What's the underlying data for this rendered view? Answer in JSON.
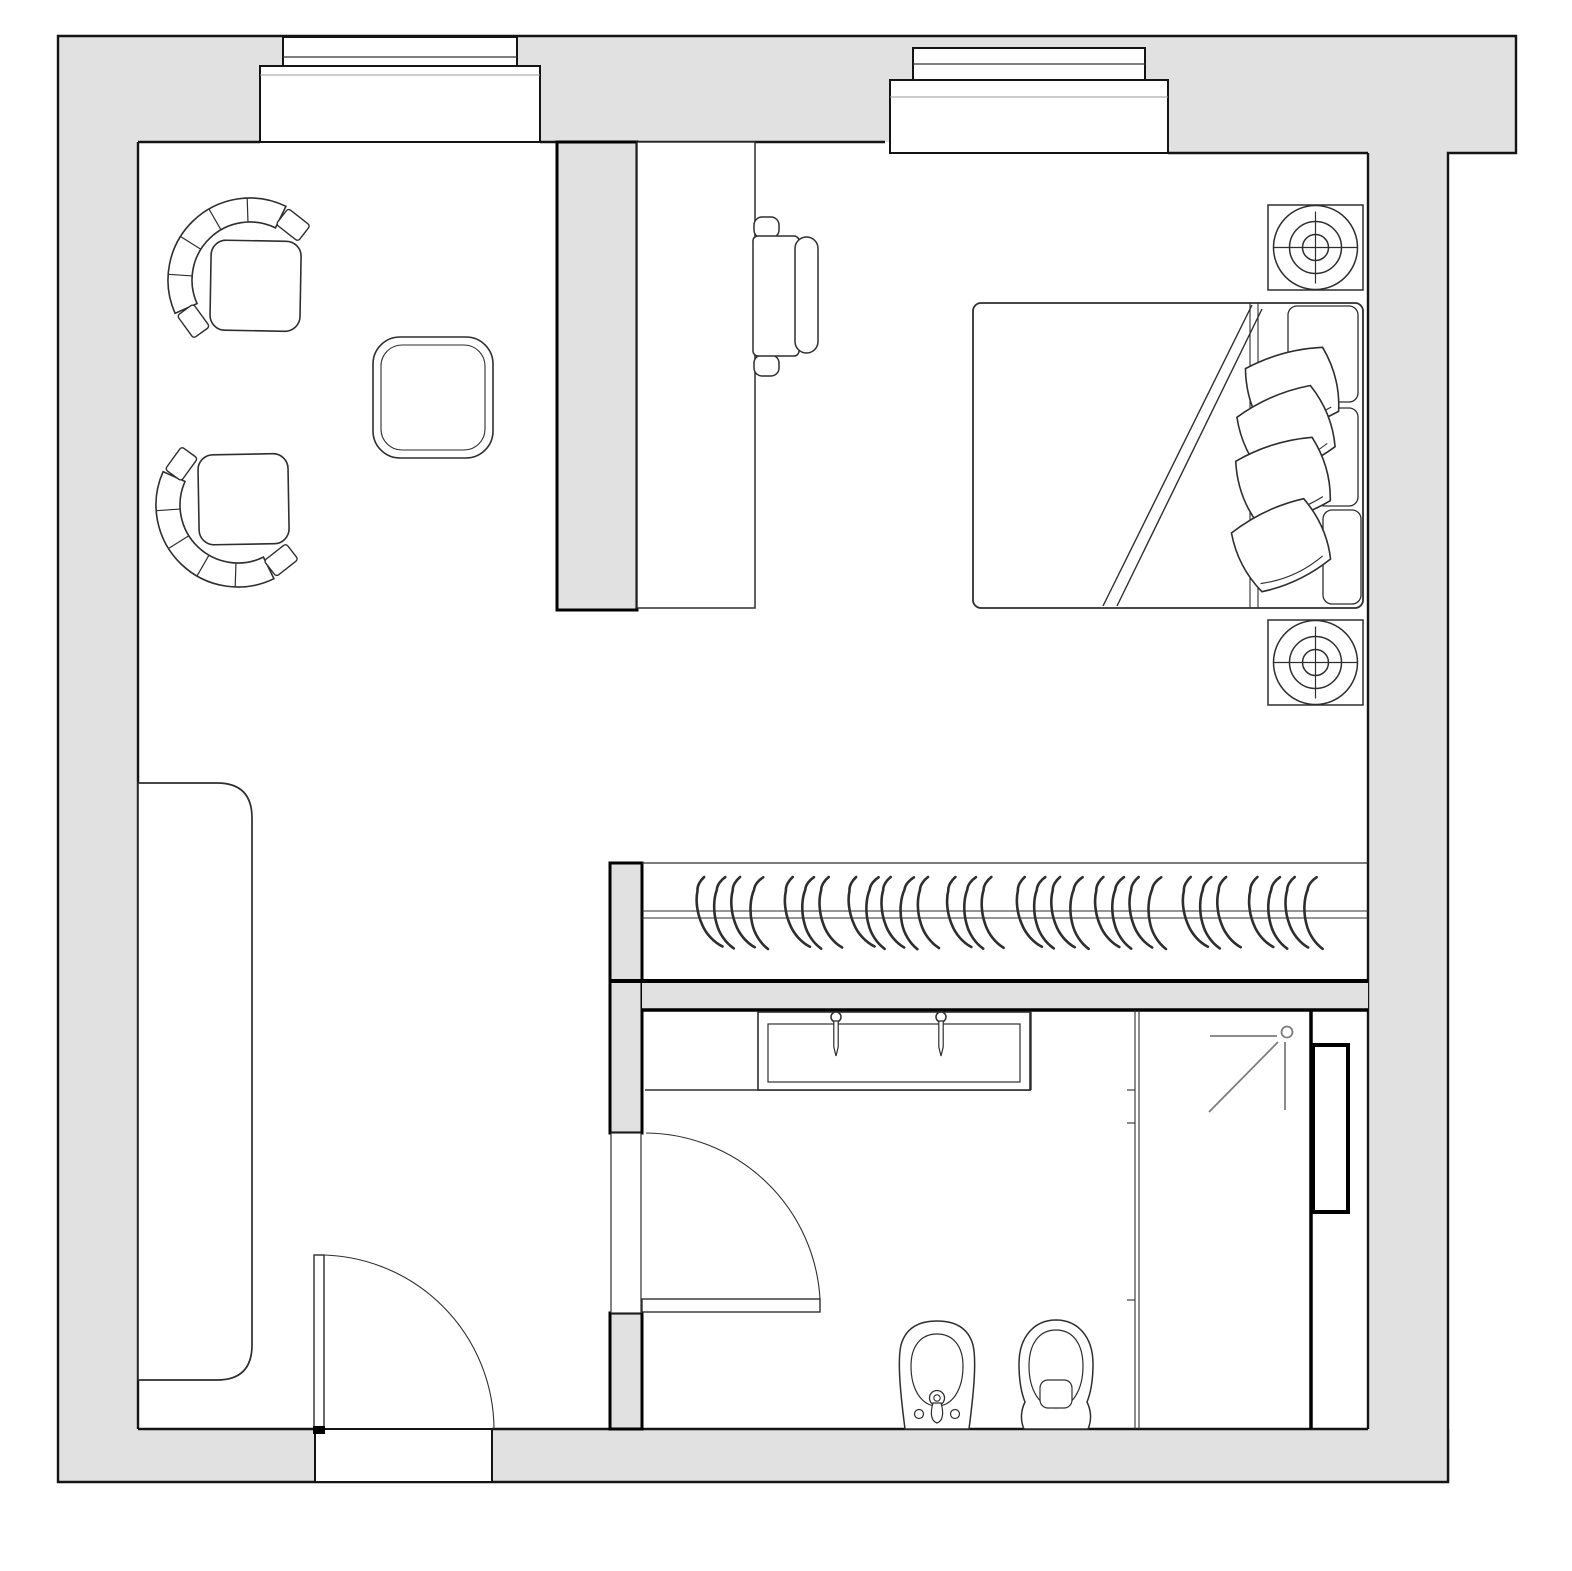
{
  "meta": {
    "title": "Apartment floor plan drawing",
    "type": "floor-plan",
    "view": "top-down plan",
    "text_on_image": "none"
  },
  "colors": {
    "background": "#ffffff",
    "wall_fill": "#e1e1e1",
    "wall_line": "#141414",
    "furniture_line": "#2e2e2e",
    "thin_line": "#555555",
    "light_line": "#9a9a9a",
    "shower_icon_line": "#7d7d7d"
  },
  "elements": {
    "rooms": [
      {
        "id": "living-area",
        "symbols": [
          "armchair",
          "armchair",
          "side-table",
          "storage-cabinet"
        ]
      },
      {
        "id": "desk-area",
        "symbols": [
          "desk",
          "office-chair",
          "partition-wall"
        ]
      },
      {
        "id": "bedroom",
        "symbols": [
          "double-bed",
          "pillows",
          "headboard-cushions",
          "speaker-nightstand",
          "speaker-nightstand"
        ]
      },
      {
        "id": "wardrobe",
        "symbols": [
          "hanging-rail",
          "clothes-hangers"
        ]
      },
      {
        "id": "bathroom",
        "symbols": [
          "vanity-counter",
          "basin",
          "faucet",
          "faucet",
          "bidet",
          "toilet",
          "shower-head",
          "shower-screen",
          "shower-niche",
          "bathroom-door"
        ]
      },
      {
        "id": "entry",
        "symbols": [
          "entry-door",
          "door-swing-arc",
          "threshold"
        ]
      }
    ],
    "windows": 2,
    "doors": 2
  },
  "wardrobe": {
    "rail_y": 914,
    "hanger_positions": [
      {
        "x": 706,
        "r": -6
      },
      {
        "x": 722,
        "r": 2
      },
      {
        "x": 740,
        "r": -3
      },
      {
        "x": 758,
        "r": 5
      },
      {
        "x": 794,
        "r": -5
      },
      {
        "x": 810,
        "r": 3
      },
      {
        "x": 828,
        "r": -2
      },
      {
        "x": 858,
        "r": -6
      },
      {
        "x": 874,
        "r": 4
      },
      {
        "x": 890,
        "r": -2
      },
      {
        "x": 908,
        "r": 6
      },
      {
        "x": 926,
        "r": 0
      },
      {
        "x": 956,
        "r": -4
      },
      {
        "x": 972,
        "r": 3
      },
      {
        "x": 990,
        "r": -1
      },
      {
        "x": 1026,
        "r": -5
      },
      {
        "x": 1042,
        "r": 2
      },
      {
        "x": 1060,
        "r": -3
      },
      {
        "x": 1078,
        "r": 4
      },
      {
        "x": 1104,
        "r": -4
      },
      {
        "x": 1120,
        "r": 3
      },
      {
        "x": 1138,
        "r": -2
      },
      {
        "x": 1156,
        "r": 5
      },
      {
        "x": 1192,
        "r": -5
      },
      {
        "x": 1208,
        "r": 2
      },
      {
        "x": 1226,
        "r": -3
      },
      {
        "x": 1258,
        "r": -4
      },
      {
        "x": 1276,
        "r": 3
      },
      {
        "x": 1294,
        "r": -2
      },
      {
        "x": 1312,
        "r": 4
      }
    ]
  },
  "bed": {
    "pillows": [
      {
        "cx": 1292,
        "cy": 390,
        "rot": -14
      },
      {
        "cx": 1286,
        "cy": 432,
        "rot": -22
      },
      {
        "cx": 1283,
        "cy": 481,
        "rot": -16
      },
      {
        "cx": 1281,
        "cy": 546,
        "rot": -24
      }
    ],
    "headboard_cushions": 3
  }
}
